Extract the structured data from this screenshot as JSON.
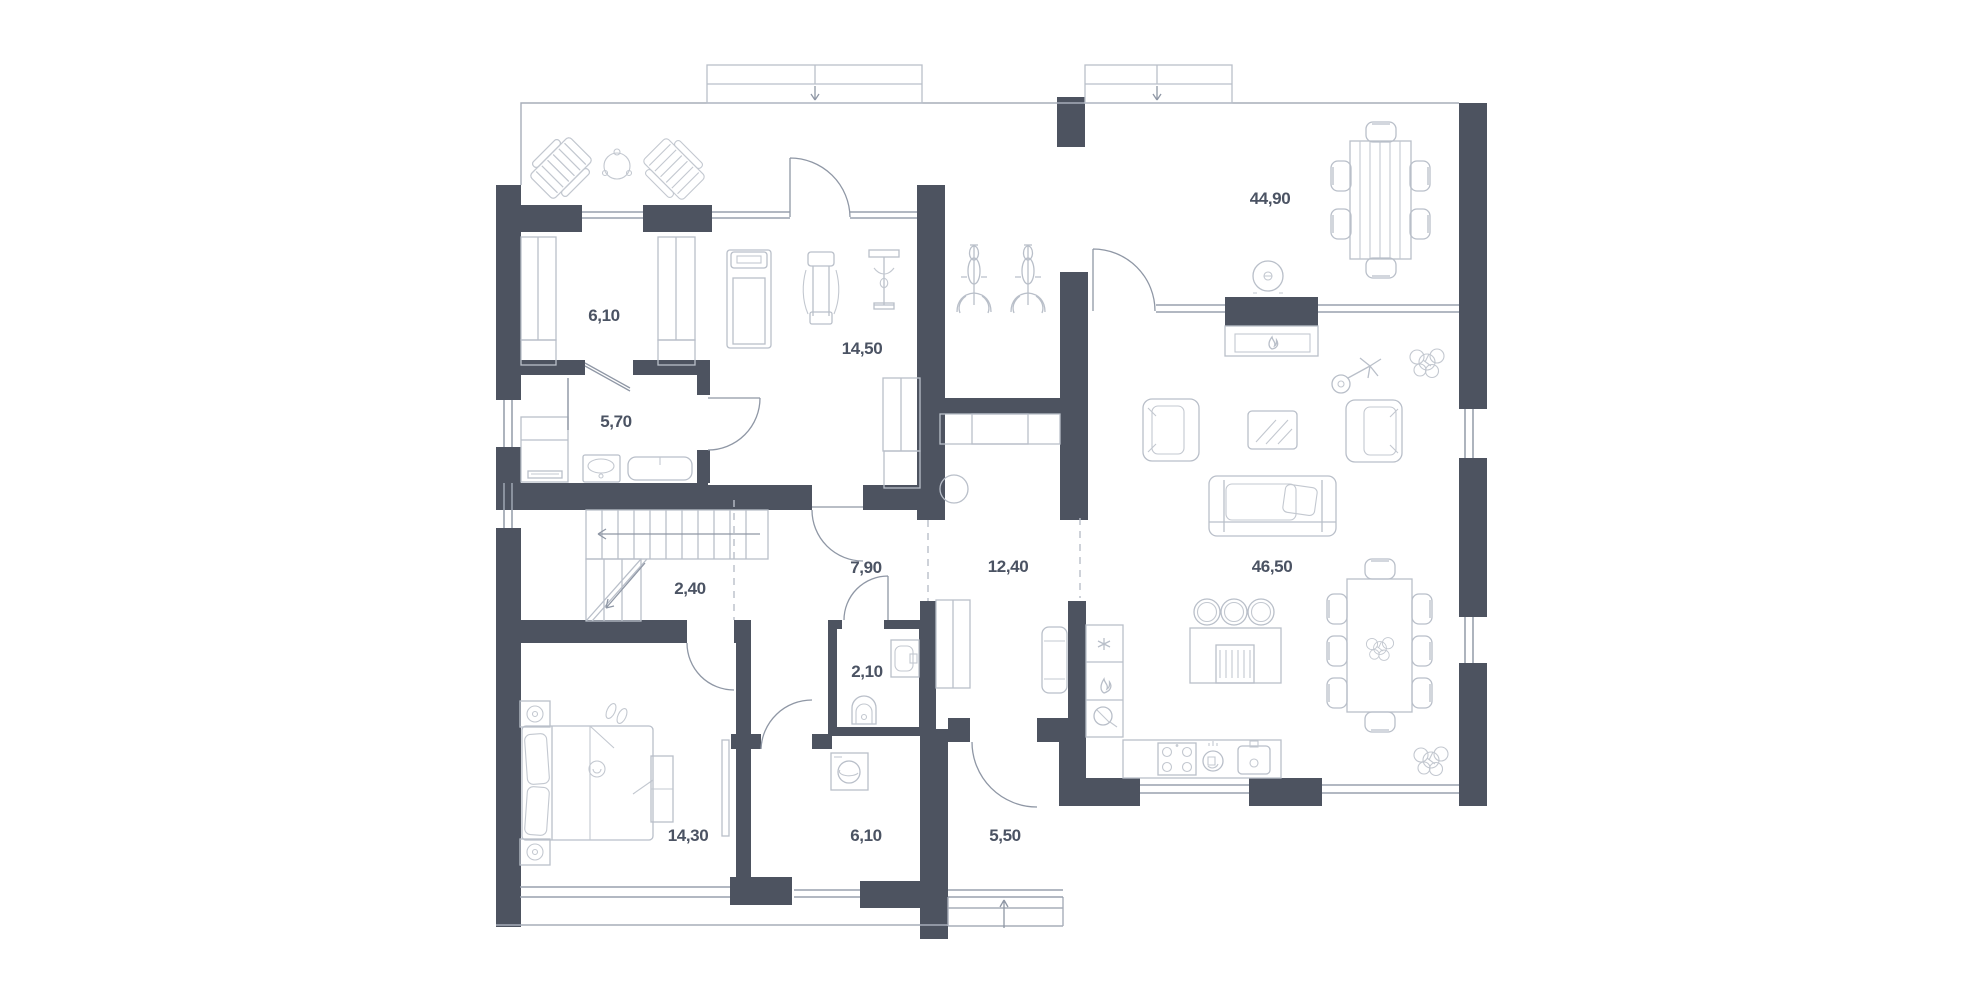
{
  "palette": {
    "background": "#ffffff",
    "wall": "#4d5360",
    "window_line": "#99a1ad",
    "furniture_line": "#b9bfc9",
    "label_text": "#4b5363"
  },
  "plan": {
    "type": "residential-floor-plan",
    "rooms": [
      {
        "id": "closet",
        "area": "6,10",
        "furniture": [
          "wardrobe-icon",
          "wardrobe-icon"
        ]
      },
      {
        "id": "bathroom",
        "area": "5,70",
        "furniture": [
          "shower-icon",
          "washbasin-icon",
          "bathtub-icon",
          "towel-radiator-icon"
        ]
      },
      {
        "id": "gym",
        "area": "14,50",
        "furniture": [
          "treadmill-icon",
          "weight-station-icon",
          "lat-machine-icon",
          "cabinet-icon"
        ]
      },
      {
        "id": "stair-hall",
        "area": "2,40",
        "furniture": [
          "staircase"
        ]
      },
      {
        "id": "hall",
        "area": "7,90",
        "furniture": []
      },
      {
        "id": "corridor",
        "area": "12,40",
        "furniture": [
          "wardrobe-icon",
          "stool-icon",
          "bench-icon",
          "exercise-bike-icon",
          "exercise-bike-icon"
        ]
      },
      {
        "id": "living-dining",
        "area": "44,90",
        "furniture": [
          "dining-table-icon",
          "fireplace-icon",
          "pendant-lamp-icon",
          "armchair-icon",
          "armchair-icon",
          "coffee-table-icon",
          "sofa-icon",
          "floor-lamp-icon",
          "plant-icon"
        ]
      },
      {
        "id": "kitchen-living",
        "area": "46,50",
        "furniture": [
          "kitchen-counter-icon",
          "hob-icon",
          "dishwasher-icon",
          "sink-icon",
          "island-icon",
          "bar-stool-icon",
          "dining-table-icon",
          "plant-icon"
        ]
      },
      {
        "id": "wc",
        "area": "2,10",
        "furniture": [
          "washbasin-icon",
          "toilet-icon"
        ]
      },
      {
        "id": "laundry",
        "area": "6,10",
        "furniture": [
          "washing-machine-icon"
        ]
      },
      {
        "id": "entry",
        "area": "5,50",
        "furniture": [
          "porch-steps",
          "entrance-arrow"
        ]
      },
      {
        "id": "bedroom",
        "area": "14,30",
        "furniture": [
          "bed-icon",
          "nightstand-icon",
          "nightstand-icon",
          "tv-icon",
          "dresser-icon",
          "slippers-icon"
        ]
      }
    ],
    "outdoor": {
      "terrace_furniture": [
        "sun-lounger-icon",
        "terrace-table-icon",
        "sun-lounger-icon"
      ],
      "roof_vents": [
        "chimney-arrow-down",
        "chimney-arrow-down"
      ]
    }
  }
}
